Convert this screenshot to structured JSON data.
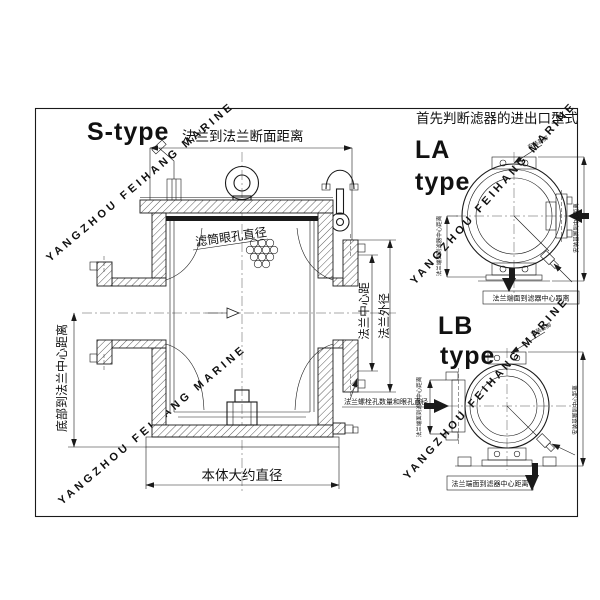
{
  "header": {
    "s_type": "S-type",
    "rule_note": "首先判断滤器的进出口型式"
  },
  "main_view": {
    "flange_to_flange": "法兰到法兰断面距离",
    "basket_hole_dia": "滤筒眼孔直径",
    "flange_center_dist": "法兰中心距",
    "flange_od": "法兰外径",
    "bottom_to_flange_center": "底部到法兰中心距离",
    "body_dia": "本体大约直径",
    "bolt_note": "法兰螺栓孔数量和眼孔直径"
  },
  "la_view": {
    "label": "LA",
    "type_word": "type",
    "left_dim": "法兰端面到滤器中心距离",
    "right_dim": "安装基脚到中心距离",
    "bottom_dim": "法兰端面到滤器中心距离",
    "feet_note": "安装基脚"
  },
  "lb_view": {
    "label": "LB",
    "type_word": "type",
    "left_dim": "法兰端面到滤器中心距离",
    "right_dim": "安装基脚到中心距离",
    "bottom_dim": "法兰端面到滤器中心距离",
    "feet_note": "安装基脚"
  },
  "watermark": {
    "text": "YANGZHOU FEIHANG MARINE",
    "color": "#c9c9c9"
  },
  "colors": {
    "line": "#1a1a1a",
    "background": "#ffffff"
  }
}
